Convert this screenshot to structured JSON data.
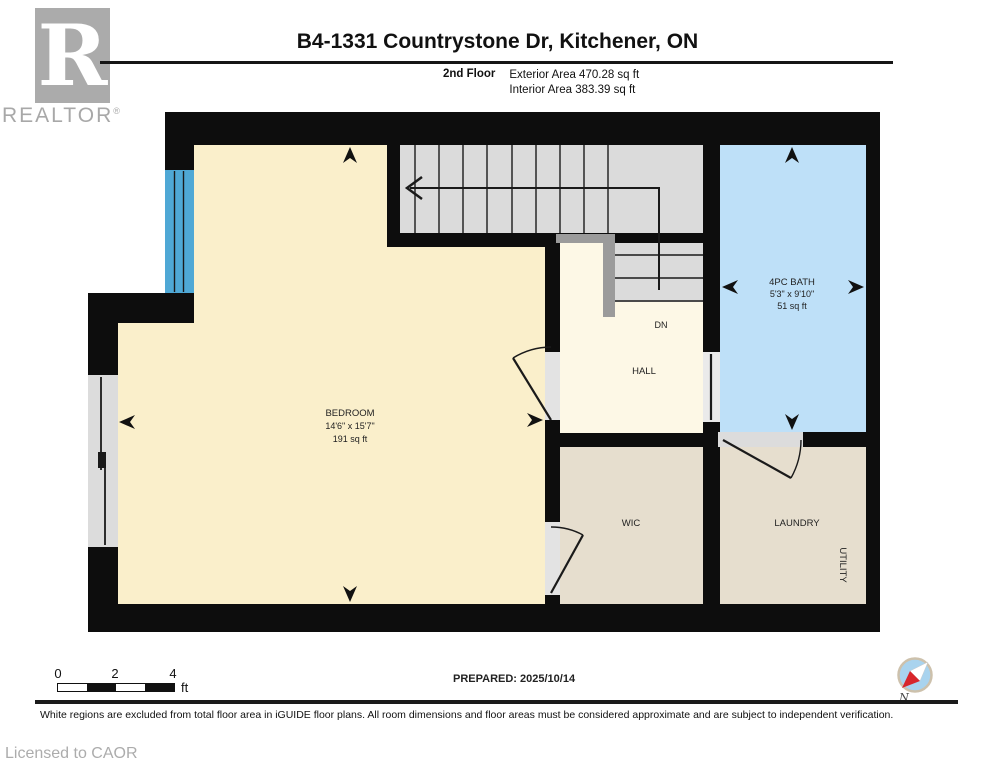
{
  "header": {
    "title": "B4-1331 Countrystone Dr, Kitchener, ON",
    "floor_label": "2nd Floor",
    "exterior_area": "Exterior Area 470.28 sq ft",
    "interior_area": "Interior Area 383.39 sq ft"
  },
  "logo": {
    "letter": "R",
    "brand": "REALTOR",
    "registered": "®"
  },
  "rooms": {
    "bedroom": {
      "name": "BEDROOM",
      "dimensions": "14'6\" x 15'7\"",
      "area": "191 sq ft"
    },
    "bath": {
      "name": "4PC BATH",
      "dimensions": "5'3\" x 9'10\"",
      "area": "51 sq ft"
    },
    "hall": {
      "name": "HALL"
    },
    "stairs": {
      "direction_label": "DN"
    },
    "wic": {
      "name": "WIC"
    },
    "laundry": {
      "name": "LAUNDRY"
    },
    "utility": {
      "name": "UTILITY"
    }
  },
  "footer": {
    "scale": {
      "t0": "0",
      "t2": "2",
      "t4": "4",
      "unit": "ft"
    },
    "prepared": "PREPARED: 2025/10/14",
    "disclaimer": "White regions are excluded from total floor area in iGUIDE floor plans. All room dimensions and floor areas must be considered approximate and are subject to independent verification.",
    "licensed": "Licensed to CAOR",
    "compass_north": "N"
  },
  "colors": {
    "wall": "#0d0d0d",
    "bedroom": "#FAEFCB",
    "hall": "#FDF8E6",
    "bath": "#BEE0F8",
    "closet": "#E6DECE",
    "stairs": "#DBDBDB",
    "railing": "#9B9B9B",
    "window_blue": "#4FA8D5",
    "window_gray": "#DCDCDC",
    "threshold": "#E3E3E3",
    "compass_fill": "#A9D3EE",
    "compass_needle": "#D8262B"
  }
}
